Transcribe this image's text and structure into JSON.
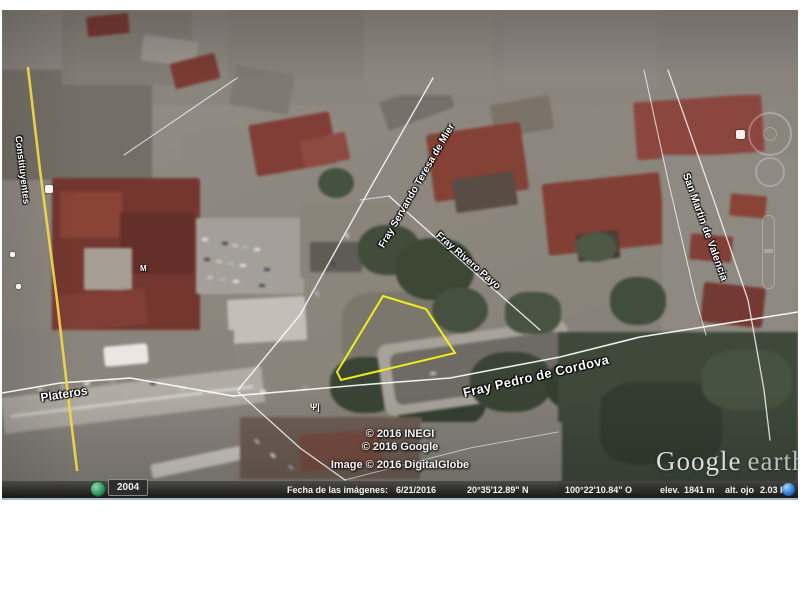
{
  "map_labels": {
    "constituyentes": "Constituyentes",
    "plateros": "Plateros",
    "fray_pedro_de_cordova": "Fray Pedro de Cordova",
    "fray_servando": "Fray Servando Teresa de Mier",
    "fray_rivero_payo": "Fray Rivero Payo",
    "san_martin_de_valencia": "San Martin de Valencia"
  },
  "parcel": {
    "outline_color": "#f6f614"
  },
  "attribution": {
    "line1": "© 2016 INEGI",
    "line2": "© 2016 Google",
    "line3": "Image © 2016 DigitalGlobe"
  },
  "logo": {
    "google": "Google",
    "earth": "earth"
  },
  "status_bar": {
    "imagery_date_label": "Fecha de las imágenes:",
    "imagery_date_value": "6/21/2016",
    "latitude": "20°35'12.89\" N",
    "longitude": "100°22'10.84\" O",
    "elevation_label": "elev.",
    "elevation_value": "1841 m",
    "eye_altitude_label": "alt. ojo",
    "eye_altitude_value": "2.03 km"
  },
  "timeline": {
    "year": "2004"
  },
  "icons": {
    "restaurant_glyph": "Ψ|",
    "marker_glyph": "M"
  }
}
